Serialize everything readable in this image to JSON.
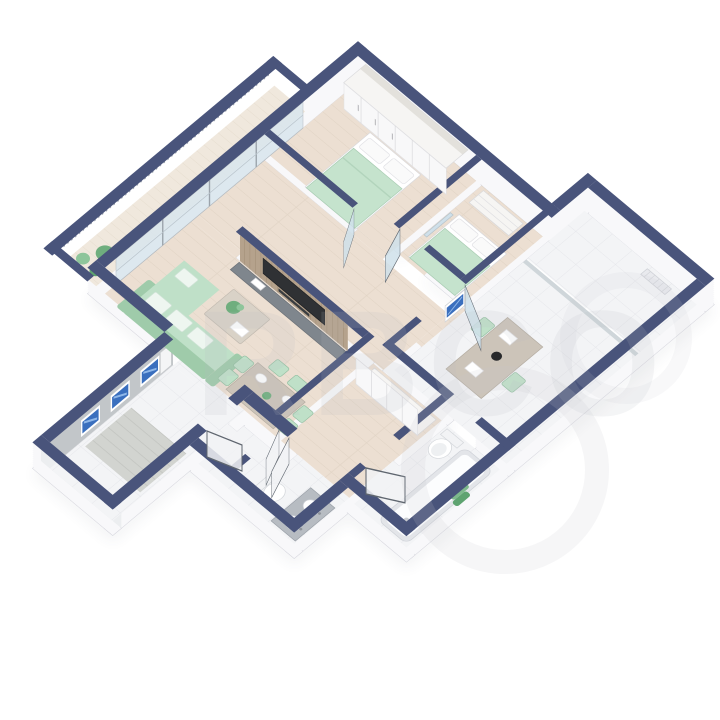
{
  "watermark": {
    "text": "RBCO"
  },
  "colors": {
    "wall_top": "#49547b",
    "wall_side": "#f8f8fa",
    "wall_shadow": "#454f63",
    "wood_floor": "#ecdfd2",
    "tile_floor": "#f3f4f6",
    "balcony_floor": "#f0e8dd",
    "glass": "#d9e6ee",
    "window_blue": "#3a6fbe",
    "furniture_green": "#bfe0c8",
    "furniture_green_dark": "#9fcbaa",
    "plant_green": "#6fae7e",
    "table_wood": "#ccc4b9",
    "tv_dark": "#2f3134",
    "slat_wood": "#b5a28c",
    "console_gray": "#7f868d",
    "fixture_white": "#fdfdfe",
    "rail_gray": "#9aa1ac",
    "watermark_gray": "#b9bcc2"
  },
  "scene": {
    "type": "3d-isometric-floor-plan",
    "view": "axonometric cutaway, plan rotated 45 degrees",
    "rooms": [
      {
        "id": "master-bedroom",
        "floor": "wood",
        "furniture": [
          "wardrobe",
          "double-bed",
          "glass-door"
        ]
      },
      {
        "id": "second-bedroom",
        "floor": "wood",
        "furniture": [
          "single-bed",
          "dresser",
          "mirror",
          "glass-door"
        ]
      },
      {
        "id": "kitchen-dining",
        "floor": "tile",
        "furniture": [
          "dining-table",
          "two-chairs",
          "wall-picture",
          "glass-door"
        ]
      },
      {
        "id": "top-balcony",
        "floor": "tile",
        "furniture": [
          "radiator"
        ]
      },
      {
        "id": "living-room",
        "floor": "wood",
        "furniture": [
          "sofa",
          "coffee-table",
          "plant",
          "tv-slat-wall",
          "dining-table",
          "six-chairs"
        ]
      },
      {
        "id": "hallway",
        "floor": "wood",
        "furniture": [
          "wardrobe"
        ]
      },
      {
        "id": "bathroom",
        "floor": "tile",
        "furniture": [
          "bathtub",
          "toilet",
          "towels"
        ]
      },
      {
        "id": "wc",
        "floor": "tile",
        "furniture": [
          "vanity-two-sinks",
          "toilet"
        ]
      },
      {
        "id": "entry-corridor",
        "floor": "tile",
        "furniture": [
          "doormat",
          "blue-windows",
          "end-window"
        ]
      },
      {
        "id": "west-balcony",
        "floor": "wood",
        "furniture": [
          "railing",
          "plants"
        ]
      }
    ]
  }
}
